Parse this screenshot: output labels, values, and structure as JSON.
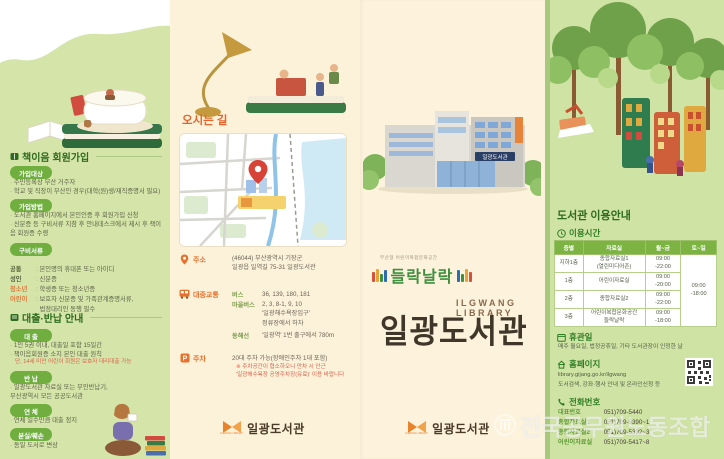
{
  "colors": {
    "accent_orange": "#e8632b",
    "green_dark": "#2e6b1e",
    "badge_green": "#6fae3f",
    "panel_green": "#d5e5a9",
    "panel_cream": "#fcf2da",
    "table_header_green": "#7cb342",
    "logo_brown": "#40372a",
    "pin_red": "#d84338"
  },
  "watermark": {
    "text": "전국공무원노동조합"
  },
  "panel_membership": {
    "title": "책이음 회원가입",
    "join_target": {
      "badge": "가입대상",
      "line1": "주민등록상 부산 거주자",
      "line2": "학교 및 직장이 부산인 경우(대학(원)생/재직증명서 필요)"
    },
    "join_method": {
      "badge": "가입방법",
      "line1": "도서관 홈페이지에서 본인인증 후 회원가입 신청",
      "line2": "신분증 등 구비서류 지참 후 안내데스크에서 제시 후 책이음 회원증 수령"
    },
    "documents": {
      "badge": "구비서류",
      "rows": [
        {
          "label": "공통",
          "value": "본인명의 휴대폰 또는 아이디"
        },
        {
          "label": "성인",
          "value": "신분증"
        },
        {
          "label": "청소년",
          "value": "학생증 또는 청소년증"
        },
        {
          "label": "어린이",
          "value": "보호자 신분증 및 가족관계증명서류,\n법정대리인 동행 필수"
        }
      ]
    },
    "loan_title": "대출·반납 안내",
    "loan": {
      "badge": "대 출",
      "line1": "1인 5권 이내, 대출일 포함 15일간",
      "line2": "책이음회원증 소지 본인 대출 원칙",
      "note": "단, 14세 미만 어린이 회원은 보호자 대리대출 가능"
    },
    "return": {
      "badge": "반 납",
      "line1": "일광도서관 자료실 또는 무인반납기,\n부산광역시 모든 공공도서관"
    },
    "overdue": {
      "badge": "연 체",
      "line1": "연체 일수만큼 대출 정지"
    },
    "lost": {
      "badge": "분실/훼손",
      "line1": "동일 도서로 변상"
    }
  },
  "panel_directions": {
    "title": "오시는 길",
    "address": {
      "label": "주소",
      "value": "(46044) 부산광역시 기장군\n일광읍 일역길 75-31 일광도서관"
    },
    "transit": {
      "label": "대중교통",
      "bus_label": "버스",
      "bus_value": "36, 139, 180, 181",
      "village_label": "마을버스",
      "village_value": "2, 3, 8-1, 9, 10\n'일광해수욕장입구'\n정류장에서 하차",
      "rail_label": "동해선",
      "rail_value": "'일광역' 1번 출구에서 780m"
    },
    "parking": {
      "label": "주차",
      "value": "20대 주차 가능(장애인주차 1대 포함)",
      "note": "※ 주차공간이 협소하오니 만차 시 인근\n'일광해수욕장 공영주차장(유료)' 이용 바랍니다"
    }
  },
  "panel_brand": {
    "building_sign": "일광도서관",
    "brand_small": "부산형 어린이복합문화공간",
    "brand_name": "들락날락",
    "logo_en": "ILGWANG LIBRARY",
    "logo_kr": "일광도서관"
  },
  "footer": {
    "logo_text": "일광도서관",
    "logo_caption": "ILGWANG LIBRARY"
  },
  "panel_info": {
    "title": "도서관 이용안내",
    "hours_title": "이용시간",
    "table": {
      "headers": [
        "층별",
        "자료실",
        "월~금",
        "토~일"
      ],
      "rows": [
        {
          "floor": "지하1층",
          "room": "종합자료실1\n(열린미디어존)",
          "weekday": "09:00\n-22:00"
        },
        {
          "floor": "1층",
          "room": "어린이자료실",
          "weekday": "09:00\n-20:00"
        },
        {
          "floor": "2층",
          "room": "종합자료실2",
          "weekday": "09:00\n-22:00"
        },
        {
          "floor": "3층",
          "room": "어린이복합문화공간\n들락날락",
          "weekday": "09:00\n-18:00"
        }
      ],
      "weekend": "09:00\n-18:00"
    },
    "closed": {
      "title": "휴관일",
      "line": "매주 월요일, 법정공휴일, 기타 도서관장이 인정한 날"
    },
    "homepage": {
      "title": "홈페이지",
      "line1": "library.gijang.go.kr/ilgwang",
      "line2": "도서검색, 강좌·행사 안내 및 온라인신청 등"
    },
    "phone": {
      "title": "전화번호",
      "rows": [
        {
          "label": "대표번호",
          "value": "051)709-5440"
        },
        {
          "label": "종합자료실1",
          "value": "051)709-5390~1"
        },
        {
          "label": "종합자료실2",
          "value": "051)709-5392~3"
        },
        {
          "label": "어린이자료실",
          "value": "051)709-5417~8"
        }
      ]
    }
  }
}
